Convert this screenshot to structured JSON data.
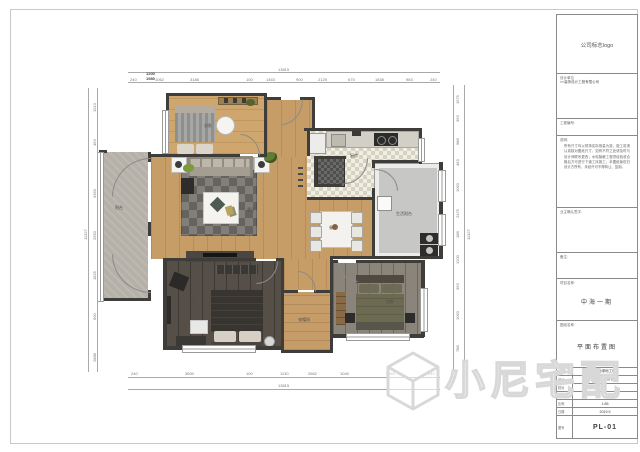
{
  "watermark": {
    "text": "小尼宅配",
    "icon": "cube-logo"
  },
  "titleblock": {
    "logo_text": "公司标志logo",
    "company_label": "设计单位",
    "company_value": "××装饰设计工程有限公司",
    "project_no_label": "工程编号:",
    "notes_label": "说明:",
    "notes_text": "所有尺寸均以现场实际测量为准，施工前请认真核对图纸尺寸，如有不符之处请及时与设计师联系更改；水电隐蔽工程须经验收合格后方可进行下道工序施工；本图纸版权归设计方所有，未经许可不得转让、复制。",
    "owner_sign_label": "业主确认签字:",
    "remark_label": "备注:",
    "project_name_label": "项目名称:",
    "project_name": "中海一期",
    "drawing_name_label": "图纸名称:",
    "drawing_name": "平面布置图",
    "table": {
      "rows": [
        {
          "label": "制图",
          "value": "上海绿地工程"
        },
        {
          "label": "设计",
          "value": "华通环境设计师"
        },
        {
          "label": "校对",
          "value": ""
        },
        {
          "label": "审核",
          "value": ""
        },
        {
          "label": "比例",
          "value": "1:85"
        },
        {
          "label": "日期",
          "value": "2019.9"
        }
      ],
      "drawing_no_label": "图号",
      "drawing_no": "PL-01"
    }
  },
  "plan": {
    "rooms": {
      "bedroom1": "次卧",
      "kitchen": "厨房",
      "living": "客厅",
      "balcony": "阳台",
      "dining": "餐厅",
      "utility": "生活阳台",
      "master": "主卧",
      "cloak": "衣帽间",
      "bedroom2": "次卧"
    }
  },
  "dims": {
    "top_overall": "13815",
    "bottom_overall": "13815",
    "left_overall": "11327",
    "right_overall": "11327",
    "stack_top": "1200",
    "stack_bottom": "1980",
    "top": [
      "240",
      "1062",
      "3188",
      "100",
      "1463",
      "900",
      "2125",
      "675",
      "1838",
      "983",
      "240"
    ],
    "bottom": [
      "240",
      "3600",
      "100",
      "1130",
      "2662",
      "1040",
      "3063",
      "240"
    ],
    "left": [
      "1513",
      "463",
      "3363",
      "2550",
      "1825",
      "600",
      "2888"
    ],
    "right": [
      "1575",
      "363",
      "988",
      "463",
      "1063",
      "2475",
      "188",
      "1200",
      "363",
      "1063",
      "788"
    ]
  }
}
